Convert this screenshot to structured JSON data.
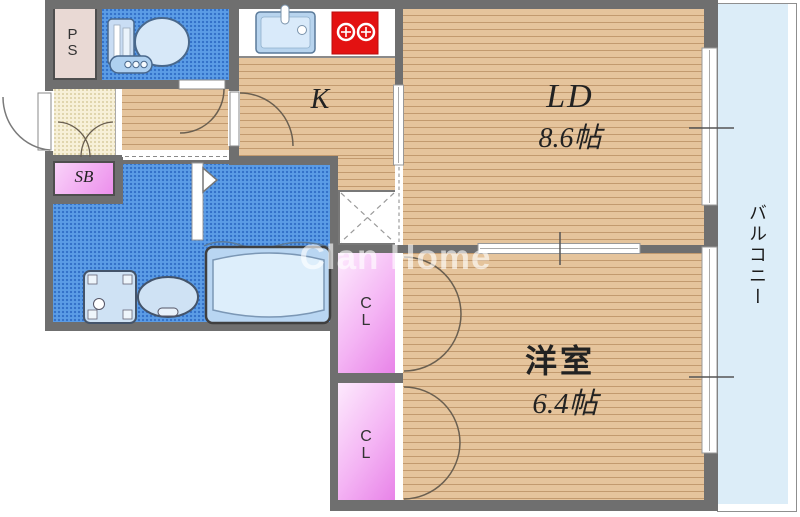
{
  "floorplan": {
    "watermark": "Clan Home",
    "labels": {
      "ps": "PS",
      "kitchen": "K",
      "living_dining": "LD",
      "living_dining_size": "8.6帖",
      "western_room": "洋室",
      "western_room_size": "6.4帖",
      "closet_upper": "CL",
      "closet_lower": "CL",
      "shoe_box": "SB",
      "balcony": "バルコニー"
    },
    "colors": {
      "wall": "#6f6f6f",
      "wood_floor": "#e5c49c",
      "wet_area_blue": "#5b9ce6",
      "balcony_blue": "#dcedf8",
      "closet_pink": "#ee8fee",
      "entrance_cream": "#f7f0d8",
      "pipe_space_beige": "#e9d9d4",
      "stove_red": "#e31212"
    }
  }
}
